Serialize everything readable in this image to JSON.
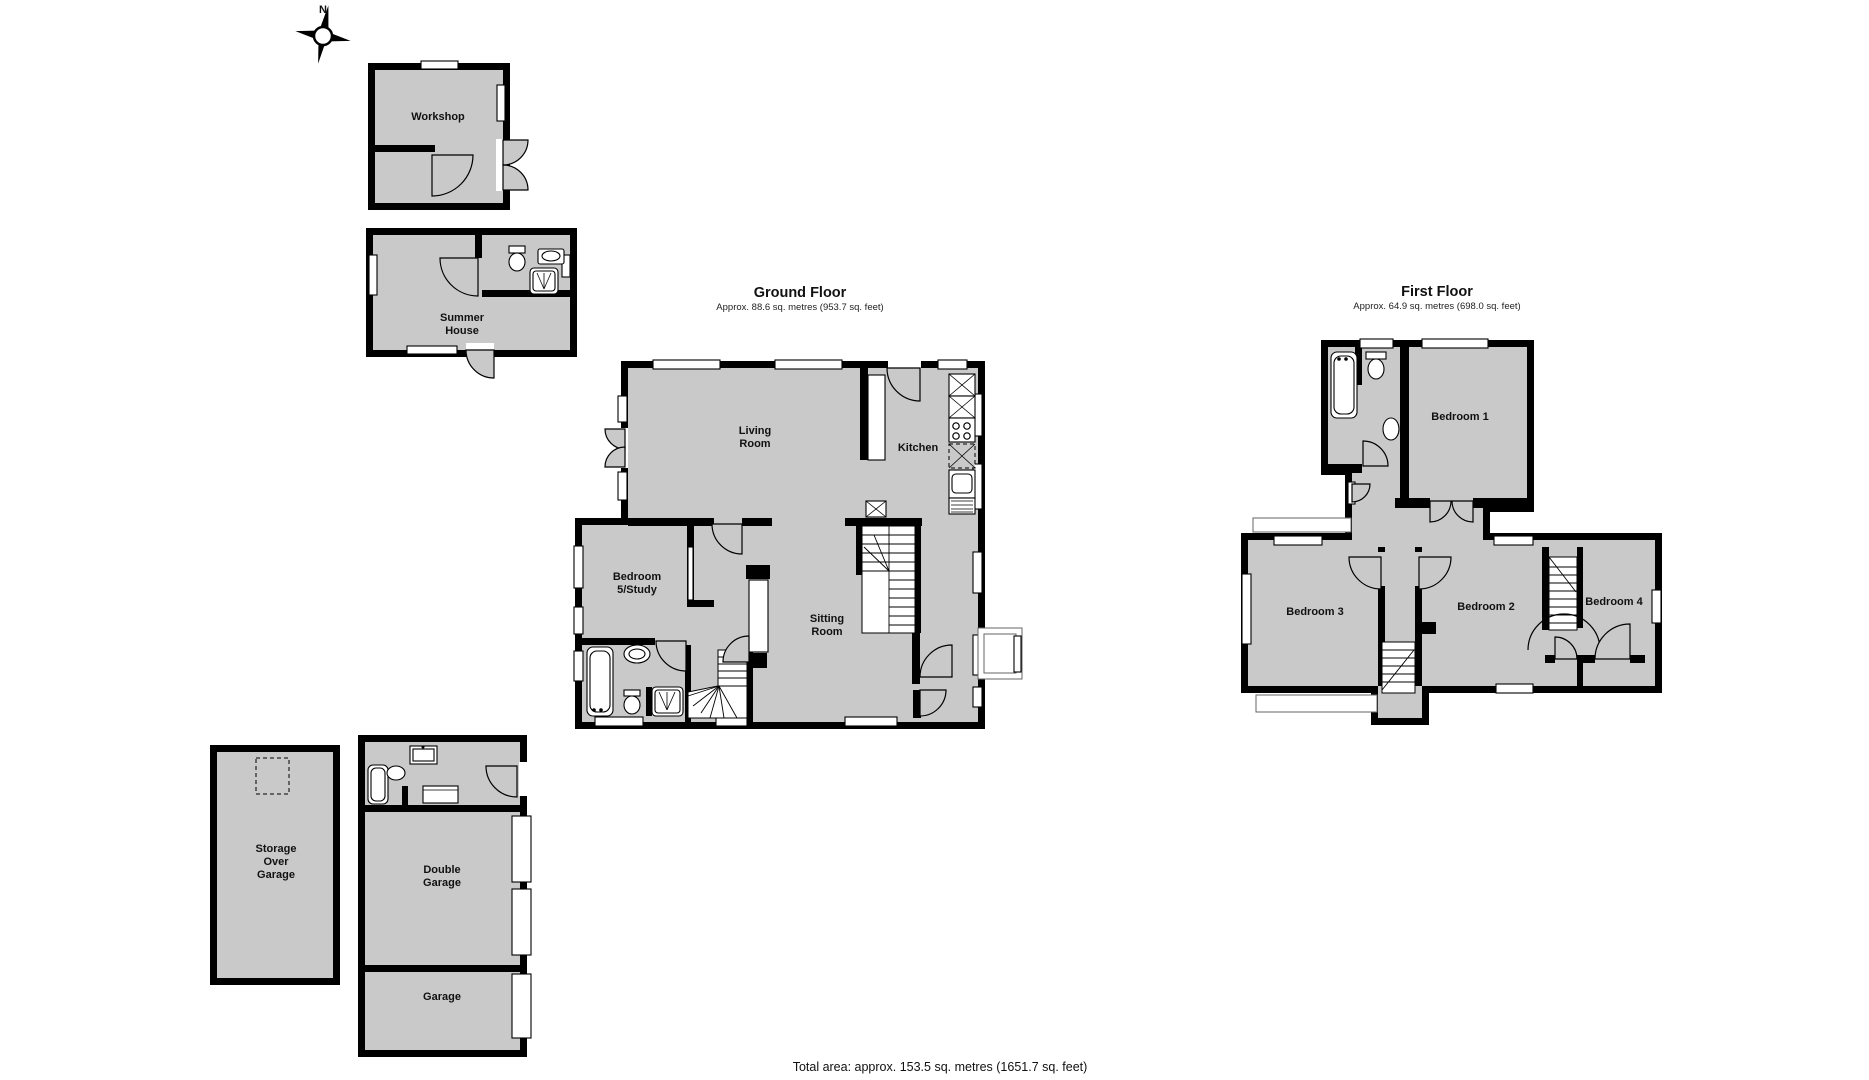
{
  "colors": {
    "wall": "#000000",
    "floor": "#c9c9c9",
    "window": "#ffffff",
    "background": "#ffffff"
  },
  "compass": {
    "north": "N"
  },
  "outbuildings": {
    "workshop": "Workshop",
    "summer_house": "Summer House"
  },
  "ground_floor": {
    "title": "Ground Floor",
    "area": "Approx. 88.6 sq. metres (953.7 sq. feet)",
    "rooms": {
      "living_room": "Living Room",
      "kitchen": "Kitchen",
      "bedroom5": "Bedroom 5/Study",
      "sitting_room": "Sitting Room"
    }
  },
  "first_floor": {
    "title": "First Floor",
    "area": "Approx. 64.9 sq. metres (698.0 sq. feet)",
    "rooms": {
      "bedroom1": "Bedroom 1",
      "bedroom2": "Bedroom 2",
      "bedroom3": "Bedroom 3",
      "bedroom4": "Bedroom 4"
    }
  },
  "garage_block": {
    "storage": "Storage Over Garage",
    "double_garage": "Double Garage",
    "garage": "Garage"
  },
  "footer": {
    "total_area": "Total area: approx. 153.5 sq. metres (1651.7 sq. feet)"
  }
}
